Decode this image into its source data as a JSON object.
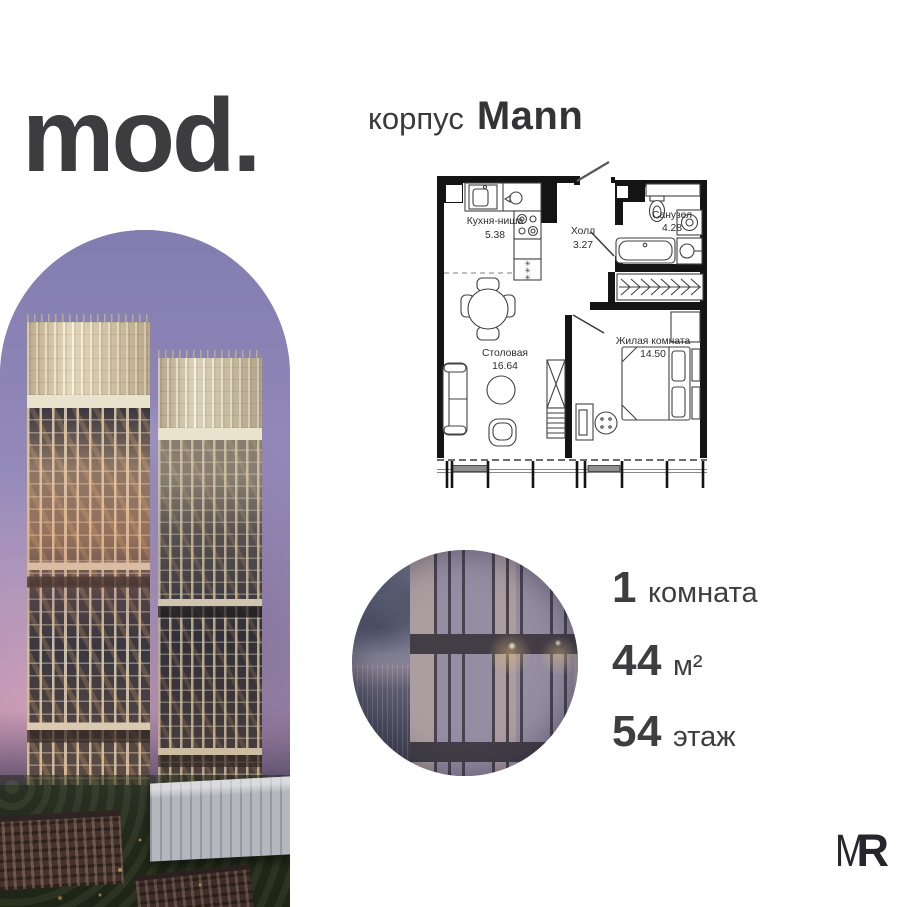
{
  "brand": {
    "logo": "mod."
  },
  "header": {
    "prefix": "корпус",
    "name": "Mann"
  },
  "plan": {
    "kitchen": {
      "name": "Кухня-ниша",
      "area": "5.38"
    },
    "hall": {
      "name": "Холл",
      "area": "3.27"
    },
    "bathroom": {
      "name": "Санузел",
      "area": "4.28"
    },
    "dining": {
      "name": "Столовая",
      "area": "16.64"
    },
    "living": {
      "name": "Жилая комната",
      "area": "14.50"
    },
    "fridge_symbol": "✳"
  },
  "specs": {
    "rooms": {
      "value": "1",
      "unit": "комната"
    },
    "area": {
      "value": "44",
      "unit": "м²"
    },
    "floor": {
      "value": "54",
      "unit": "этаж"
    }
  },
  "partner": {
    "m": "M",
    "r": "R"
  },
  "colors": {
    "text": "#3d3d3f",
    "plan_walls": "#141414",
    "sky_violet": "#8d84b6",
    "sunset_pink": "#e0aac2",
    "tower_beige": "#d8c8a6",
    "facade_mauve": "#a79b9d",
    "ground_green": "#232718"
  }
}
